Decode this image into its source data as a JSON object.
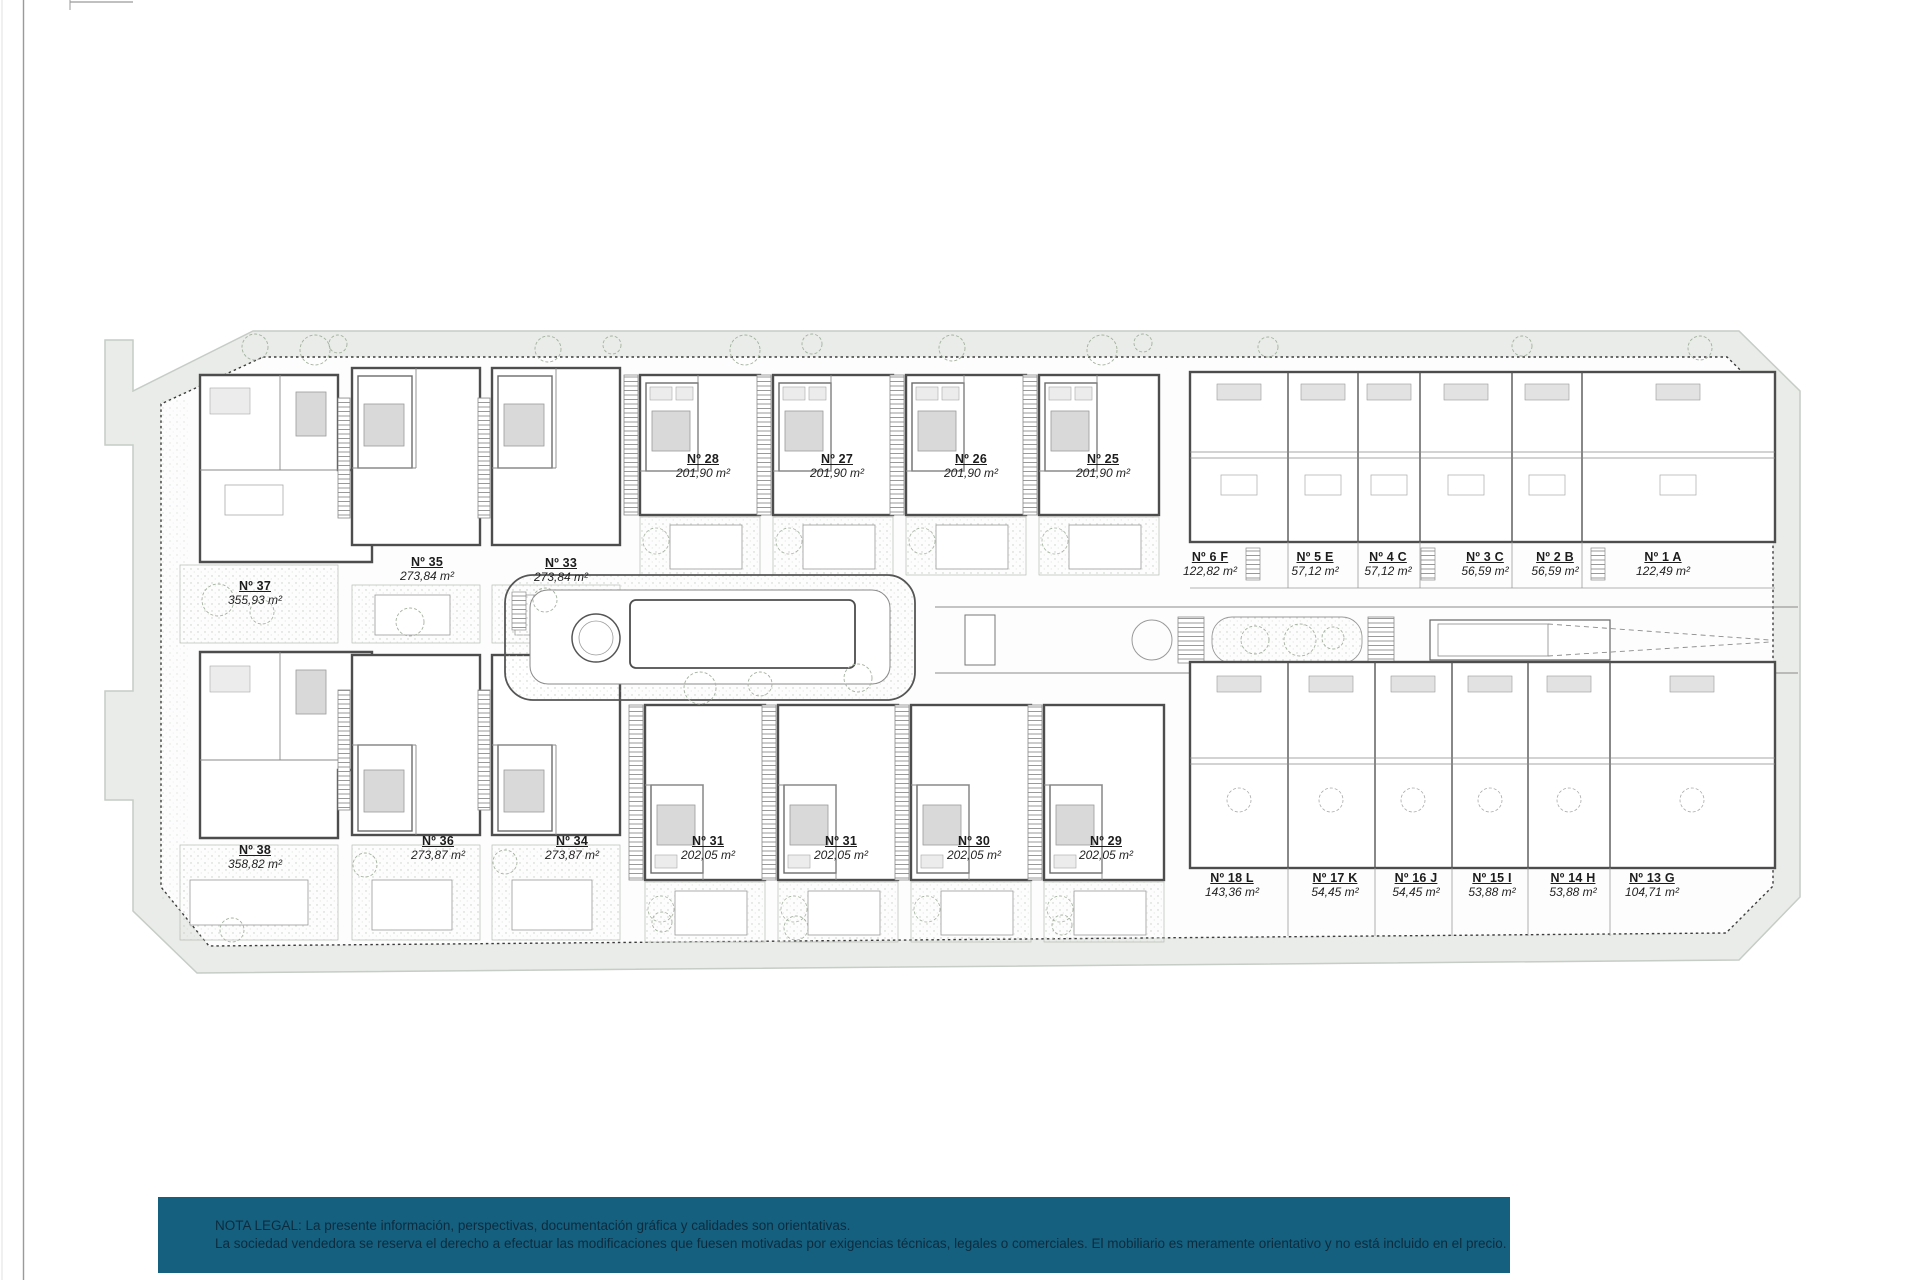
{
  "plan": {
    "units": [
      {
        "label": "Nº 37",
        "area": "355,93 m²"
      },
      {
        "label": "Nº 35",
        "area": "273,84 m²"
      },
      {
        "label": "Nº 33",
        "area": "273,84 m²"
      },
      {
        "label": "Nº 28",
        "area": "201,90 m²"
      },
      {
        "label": "Nº 27",
        "area": "201,90 m²"
      },
      {
        "label": "Nº 26",
        "area": "201,90 m²"
      },
      {
        "label": "Nº 25",
        "area": "201,90 m²"
      },
      {
        "label": "Nº 6 F",
        "area": "122,82 m²"
      },
      {
        "label": "Nº 5 E",
        "area": "57,12 m²"
      },
      {
        "label": "Nº 4 C",
        "area": "57,12 m²"
      },
      {
        "label": "Nº 3 C",
        "area": "56,59 m²"
      },
      {
        "label": "Nº 2 B",
        "area": "56,59 m²"
      },
      {
        "label": "Nº 1 A",
        "area": "122,49 m²"
      },
      {
        "label": "Nº 38",
        "area": "358,82 m²"
      },
      {
        "label": "Nº 36",
        "area": "273,87 m²"
      },
      {
        "label": "Nº 34",
        "area": "273,87 m²"
      },
      {
        "label": "Nº 31",
        "area": "202,05 m²"
      },
      {
        "label": "Nº 31",
        "area": "202,05 m²"
      },
      {
        "label": "Nº 30",
        "area": "202,05 m²"
      },
      {
        "label": "Nº 29",
        "area": "202,05 m²"
      },
      {
        "label": "Nº 18 L",
        "area": "143,36 m²"
      },
      {
        "label": "Nº 17 K",
        "area": "54,45 m²"
      },
      {
        "label": "Nº 16 J",
        "area": "54,45 m²"
      },
      {
        "label": "Nº 15 I",
        "area": "53,88 m²"
      },
      {
        "label": "Nº 14 H",
        "area": "53,88 m²"
      },
      {
        "label": "Nº 13 G",
        "area": "104,71 m²"
      }
    ]
  },
  "legal": {
    "line1": "NOTA LEGAL: La presente información, perspectivas, documentación gráfica y calidades son orientativas.",
    "line2": "La sociedad vendedora se reserva el derecho a efectuar las modificaciones que fuesen motivadas por exigencias técnicas, legales o comerciales. El mobiliario es meramente orientativo y no está incluido en el precio."
  },
  "colors": {
    "banner_background": "#15607f",
    "banner_text": "#0d2b3e",
    "site_band": "#e9ece8",
    "wall": "#4d4d4d"
  }
}
